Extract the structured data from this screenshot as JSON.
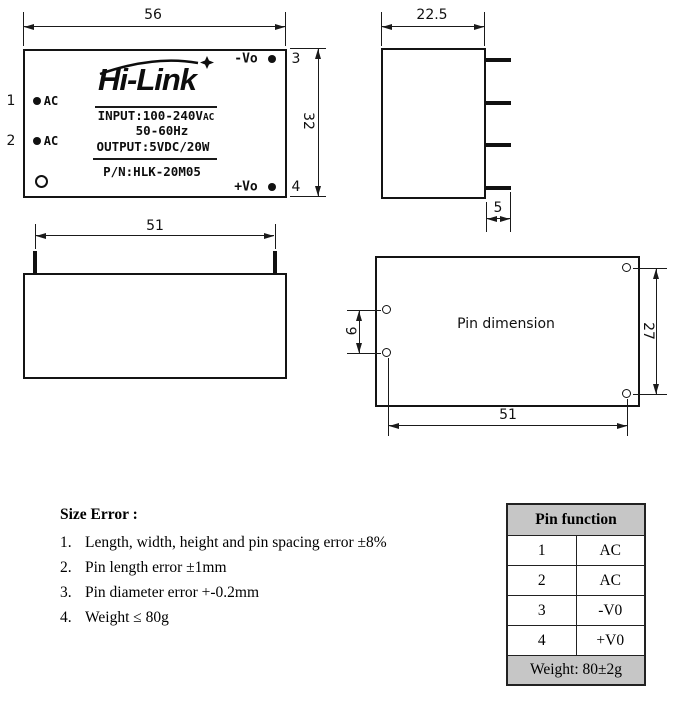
{
  "front_view": {
    "dim_width": "56",
    "dim_height": "32",
    "logo_text": "Hi-Link",
    "input_line": "INPUT:100-240V",
    "input_suffix": "AC",
    "freq_line": "50-60Hz",
    "output_line": "OUTPUT:5VDC/20W",
    "pn_line": "P/N:HLK-20M05",
    "pin1_num": "1",
    "pin1_label": "AC",
    "pin2_num": "2",
    "pin2_label": "AC",
    "pin3_num": "3",
    "pin3_label": "-Vo",
    "pin4_num": "4",
    "pin4_label": "+Vo"
  },
  "side_view": {
    "dim_width": "22.5",
    "dim_pin_length": "5"
  },
  "bottom_view": {
    "dim_pin_spacing": "51"
  },
  "pin_dim_view": {
    "title": "Pin dimension",
    "dim_left_spacing": "9",
    "dim_right_spacing": "27",
    "dim_bottom_spacing": "51"
  },
  "size_error": {
    "heading": "Size Error :",
    "items": [
      {
        "num": "1.",
        "text": "Length, width, height and pin spacing error ±8%"
      },
      {
        "num": "2.",
        "text": "Pin length error ±1mm"
      },
      {
        "num": "3.",
        "text": "Pin diameter error +-0.2mm"
      },
      {
        "num": "4.",
        "text": "Weight ≤ 80g"
      }
    ]
  },
  "pin_table": {
    "header": "Pin function",
    "rows": [
      {
        "pin": "1",
        "func": "AC"
      },
      {
        "pin": "2",
        "func": "AC"
      },
      {
        "pin": "3",
        "func": "-V0"
      },
      {
        "pin": "4",
        "func": "+V0"
      }
    ],
    "footer": "Weight: 80±2g",
    "header_bg": "#c6c6c6"
  },
  "colors": {
    "line": "#1a1a1a",
    "text": "#000000",
    "table_gray": "#c6c6c6"
  }
}
